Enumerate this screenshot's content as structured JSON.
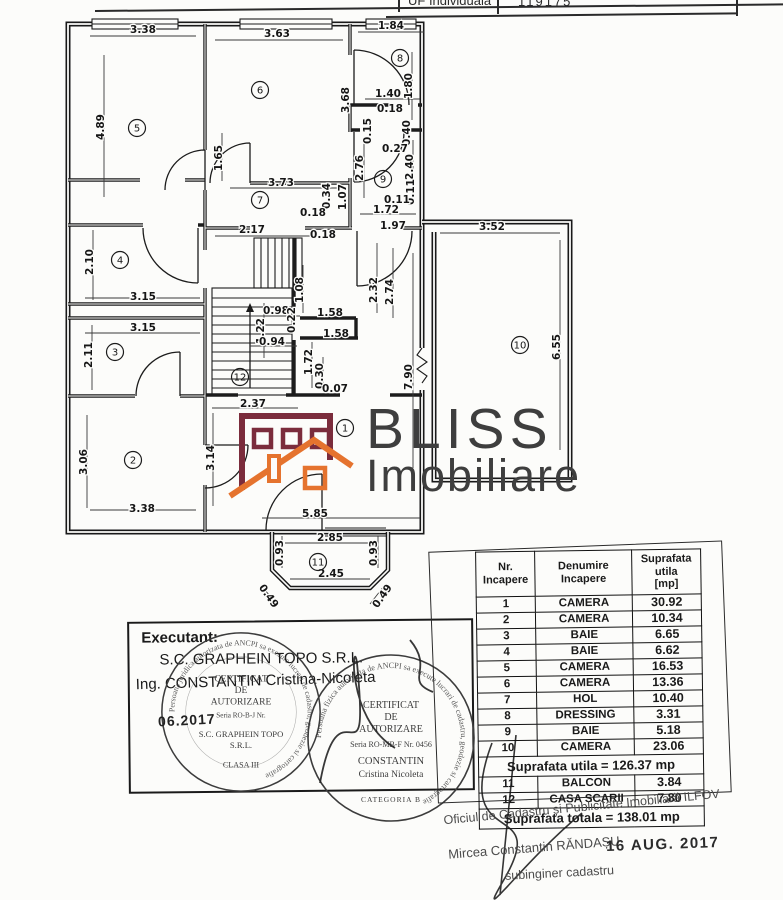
{
  "top_table": {
    "cell1": "UF Individuala",
    "cell2": "119175"
  },
  "logo": {
    "line1": "BLISS",
    "line2": "Imobiliare",
    "building_color": "#7b2c3c",
    "roof_color": "#e5732e",
    "text_color": "#3e3e3e"
  },
  "floor_plan": {
    "rooms": [
      {
        "n": "1",
        "x": 345,
        "y": 428
      },
      {
        "n": "2",
        "x": 133,
        "y": 460
      },
      {
        "n": "3",
        "x": 115,
        "y": 352
      },
      {
        "n": "4",
        "x": 120,
        "y": 260
      },
      {
        "n": "5",
        "x": 137,
        "y": 128
      },
      {
        "n": "6",
        "x": 260,
        "y": 90
      },
      {
        "n": "7",
        "x": 260,
        "y": 200
      },
      {
        "n": "8",
        "x": 400,
        "y": 58
      },
      {
        "n": "9",
        "x": 383,
        "y": 179
      },
      {
        "n": "10",
        "x": 520,
        "y": 345
      },
      {
        "n": "11",
        "x": 318,
        "y": 562
      },
      {
        "n": "12",
        "x": 240,
        "y": 377
      }
    ],
    "dimensions": [
      {
        "t": "3.38",
        "x": 143,
        "y": 33
      },
      {
        "t": "3.63",
        "x": 277,
        "y": 37
      },
      {
        "t": "1.84",
        "x": 391,
        "y": 29
      },
      {
        "t": "1.80",
        "x": 412,
        "y": 86,
        "r": -90
      },
      {
        "t": "4.89",
        "x": 104,
        "y": 127,
        "r": -90
      },
      {
        "t": "3.68",
        "x": 349,
        "y": 100,
        "r": -90
      },
      {
        "t": "1.40",
        "x": 388,
        "y": 97
      },
      {
        "t": "0.18",
        "x": 390,
        "y": 112
      },
      {
        "t": "0.15",
        "x": 371,
        "y": 131,
        "r": -90
      },
      {
        "t": "0.40",
        "x": 410,
        "y": 133,
        "r": -90
      },
      {
        "t": "0.27",
        "x": 395,
        "y": 152
      },
      {
        "t": "2.40",
        "x": 413,
        "y": 167,
        "r": -90
      },
      {
        "t": "2.76",
        "x": 363,
        "y": 168,
        "r": -90
      },
      {
        "t": "0.11",
        "x": 414,
        "y": 192,
        "r": -90
      },
      {
        "t": "0.11",
        "x": 397,
        "y": 203
      },
      {
        "t": "1.72",
        "x": 386,
        "y": 213
      },
      {
        "t": "1.65",
        "x": 222,
        "y": 158,
        "r": -90
      },
      {
        "t": "3.73",
        "x": 281,
        "y": 186
      },
      {
        "t": "0.34",
        "x": 330,
        "y": 196,
        "r": -90
      },
      {
        "t": "1.07",
        "x": 346,
        "y": 197,
        "r": -90
      },
      {
        "t": "0.18",
        "x": 313,
        "y": 216
      },
      {
        "t": "0.18",
        "x": 323,
        "y": 238
      },
      {
        "t": "2.17",
        "x": 252,
        "y": 233
      },
      {
        "t": "1.97",
        "x": 393,
        "y": 229
      },
      {
        "t": "3.52",
        "x": 492,
        "y": 230
      },
      {
        "t": "2.10",
        "x": 93,
        "y": 262,
        "r": -90
      },
      {
        "t": "3.15",
        "x": 143,
        "y": 300
      },
      {
        "t": "3.15",
        "x": 143,
        "y": 331
      },
      {
        "t": "2.11",
        "x": 92,
        "y": 355,
        "r": -90
      },
      {
        "t": "1.08",
        "x": 303,
        "y": 290,
        "r": -90
      },
      {
        "t": "0.98",
        "x": 276,
        "y": 314
      },
      {
        "t": "1.22",
        "x": 264,
        "y": 331,
        "r": -90
      },
      {
        "t": "0.94",
        "x": 272,
        "y": 345
      },
      {
        "t": "0.22",
        "x": 295,
        "y": 320,
        "r": -90
      },
      {
        "t": "2.32",
        "x": 377,
        "y": 290,
        "r": -90
      },
      {
        "t": "2.74",
        "x": 393,
        "y": 292,
        "r": -90
      },
      {
        "t": "1.58",
        "x": 330,
        "y": 316
      },
      {
        "t": "1.58",
        "x": 336,
        "y": 337
      },
      {
        "t": "1.72",
        "x": 312,
        "y": 362,
        "r": -90
      },
      {
        "t": "0.30",
        "x": 323,
        "y": 376,
        "r": -90
      },
      {
        "t": "0.07",
        "x": 335,
        "y": 392
      },
      {
        "t": "7.90",
        "x": 412,
        "y": 377,
        "r": -90
      },
      {
        "t": "6.55",
        "x": 560,
        "y": 347,
        "r": -90
      },
      {
        "t": "3.06",
        "x": 87,
        "y": 462,
        "r": -90
      },
      {
        "t": "3.14",
        "x": 214,
        "y": 458,
        "r": -90
      },
      {
        "t": "2.37",
        "x": 253,
        "y": 407
      },
      {
        "t": "3.38",
        "x": 142,
        "y": 512
      },
      {
        "t": "5.85",
        "x": 315,
        "y": 517
      },
      {
        "t": "2.85",
        "x": 330,
        "y": 541
      },
      {
        "t": "0.93",
        "x": 283,
        "y": 553,
        "r": -90
      },
      {
        "t": "0.93",
        "x": 377,
        "y": 553,
        "r": -90
      },
      {
        "t": "2.45",
        "x": 331,
        "y": 577
      },
      {
        "t": "0.49",
        "x": 266,
        "y": 598,
        "r": 55
      },
      {
        "t": "0.49",
        "x": 385,
        "y": 598,
        "r": -55
      }
    ]
  },
  "executant": {
    "title": "Executant:",
    "company": "S.C. GRAPHEIN TOPO S.R.L.",
    "engineer": "Ing. CONSTANTIN Cristina-Nicoleta",
    "stamp_date": "06.2017",
    "stamp1": {
      "ring": "Persoana juridica autorizata de ANCPI sa execute lucrari de cadastru, geodezie si cartografie",
      "l1": "CERTIFICAT",
      "l2": "DE",
      "l3": "AUTORIZARE",
      "l4": "Seria RO-B-J Nr.",
      "l5": "S.C. GRAPHEIN TOPO",
      "l6": "S.R.L.",
      "l7": "CLASA III"
    },
    "stamp2": {
      "ring": "Persoana fizica autorizata de ANCPI sa execute lucrari de cadastru, geodezie si cartografie",
      "l1": "CERTIFICAT",
      "l2": "DE",
      "l3": "AUTORIZARE",
      "l4": "Seria RO-MB-F Nr. 0456",
      "l5": "CONSTANTIN",
      "l6": "Cristina Nicoleta",
      "l7": "CATEGORIA B"
    }
  },
  "table": {
    "headers": [
      "Nr.\nIncapere",
      "Denumire\nIncapere",
      "Suprafata utila\n[mp]"
    ],
    "rows": [
      [
        "1",
        "CAMERA",
        "30.92"
      ],
      [
        "2",
        "CAMERA",
        "10.34"
      ],
      [
        "3",
        "BAIE",
        "6.65"
      ],
      [
        "4",
        "BAIE",
        "6.62"
      ],
      [
        "5",
        "CAMERA",
        "16.53"
      ],
      [
        "6",
        "CAMERA",
        "13.36"
      ],
      [
        "7",
        "HOL",
        "10.40"
      ],
      [
        "8",
        "DRESSING",
        "3.31"
      ],
      [
        "9",
        "BAIE",
        "5.18"
      ],
      [
        "10",
        "CAMERA",
        "23.06"
      ]
    ],
    "subtotal": "Suprafata utila = 126.37 mp",
    "extra_rows": [
      [
        "11",
        "BALCON",
        "3.84"
      ],
      [
        "12",
        "CASA SCARII",
        "7.80"
      ]
    ],
    "total": "Suprafata totala = 138.01 mp"
  },
  "footer": {
    "office_line": "Oficiul de Cadastru și Publicitate Imobiliară ILFOV",
    "name": "Mircea Constantin RĂNDAȘU",
    "date_stamp": "16 AUG. 2017",
    "role": "subinginer cadastru"
  }
}
